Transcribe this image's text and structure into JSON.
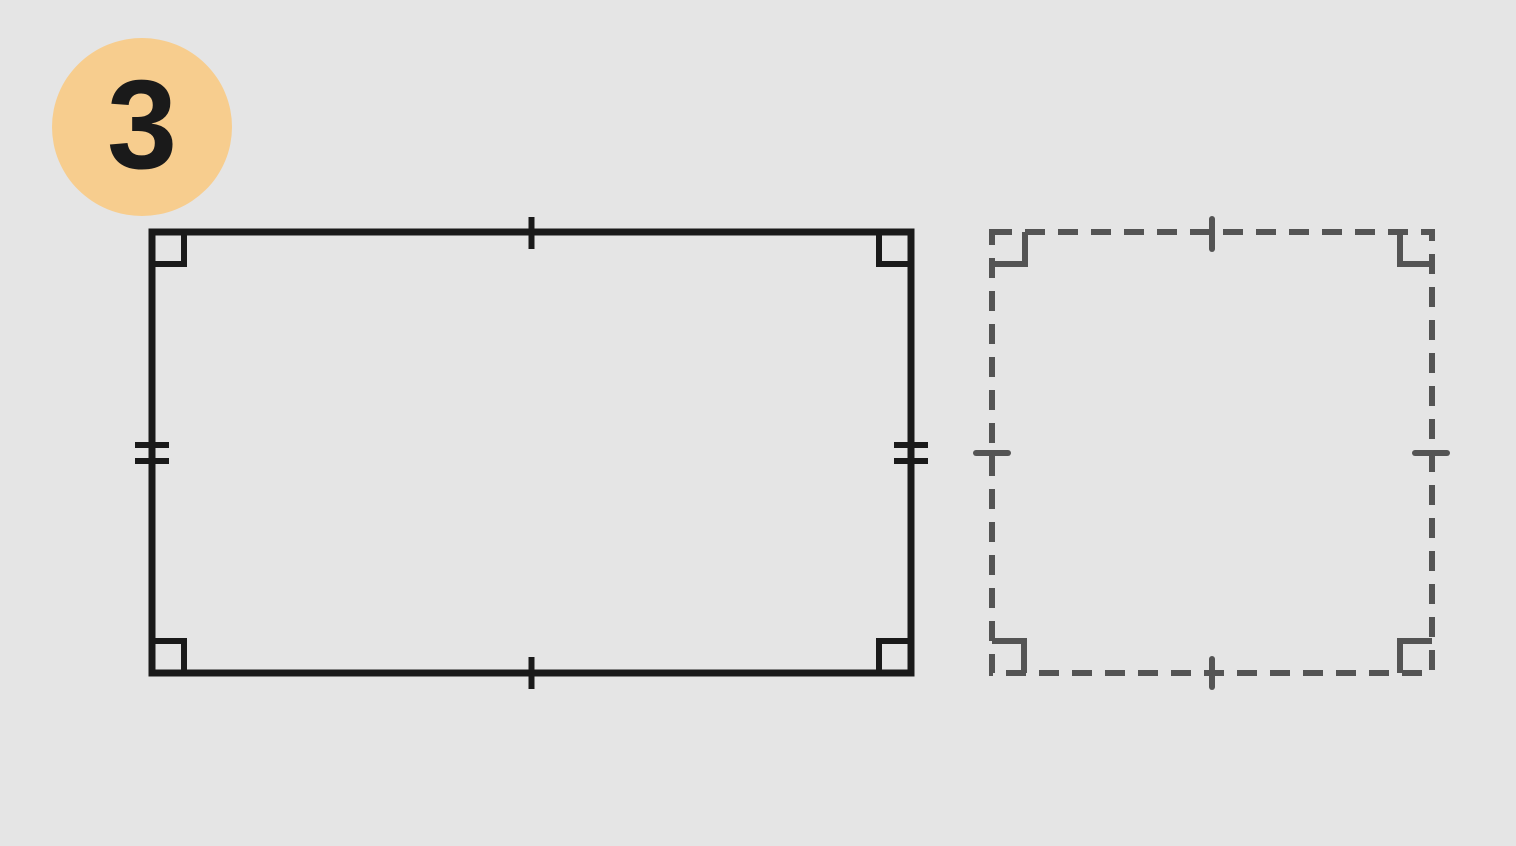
{
  "badge": {
    "label": "3"
  },
  "colors": {
    "background": "#e5e5e5",
    "badge_bg": "#f7cd8e",
    "ink": "#1a1a1a",
    "dash": "#545454"
  },
  "shapes": {
    "solid_rectangle": {
      "stroke_style": "solid",
      "corner_right_angle_marks": 4,
      "tick_marks": {
        "top": 1,
        "bottom": 1,
        "left": 2,
        "right": 2
      }
    },
    "dashed_square": {
      "stroke_style": "dashed",
      "corner_right_angle_marks": 4,
      "tick_marks": {
        "top": 1,
        "bottom": 1,
        "left": 1,
        "right": 1
      }
    }
  }
}
